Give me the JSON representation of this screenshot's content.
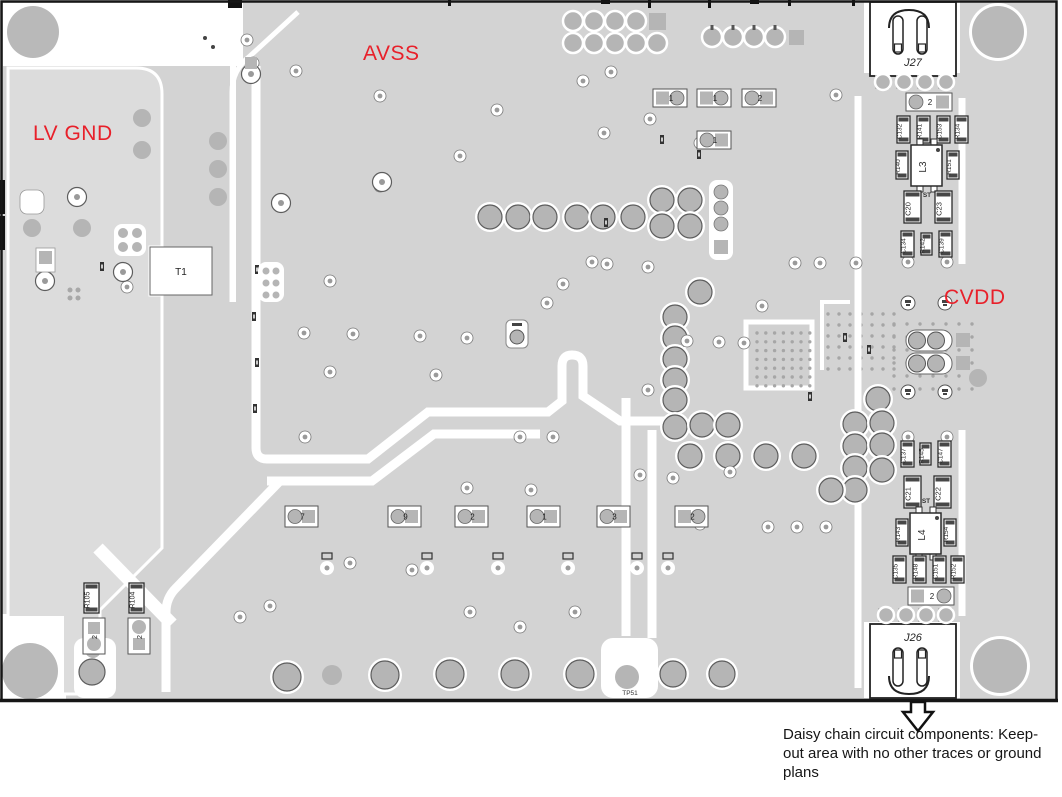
{
  "labels": {
    "lv_gnd": "LV GND",
    "avss": "AVSS",
    "cvdd": "CVDD"
  },
  "note": {
    "text": "Daisy chain circuit components: Keep-out area with no other traces or ground plans"
  },
  "colors": {
    "red": "#e8202a",
    "board": "#d3d3d3",
    "plane": "#dcdcdc",
    "pad": "#b5b5b5"
  },
  "components": {
    "j27": "J27",
    "j26": "J26",
    "t1": "T1",
    "l3": "L3",
    "l4": "L4",
    "c20": "C20",
    "c23": "C23",
    "c21": "C21",
    "c22": "C22",
    "st_top": "ST",
    "st_bottom": "ST",
    "tp51": "TP51",
    "r105": "R105",
    "r104": "R104",
    "top_row": [
      "C132",
      "R141",
      "C153",
      "R134"
    ],
    "l3_left": "R140",
    "l3_right": "R151",
    "mid_row": [
      "C134",
      "R142",
      "C139"
    ],
    "cvdd_row": [
      "C137",
      "R145",
      "C147"
    ],
    "l4_left": "R143",
    "l4_right": "R154",
    "bottom_row": [
      "C135",
      "R148",
      "C151",
      "R152"
    ],
    "jumpers": {
      "top": "2",
      "bottom": "2",
      "h1": "1",
      "h2": "1",
      "h3": "2",
      "h4": "1",
      "row": [
        "7",
        "9",
        "2",
        "1",
        "3",
        "2"
      ],
      "left1": "2",
      "left2": "2"
    }
  }
}
